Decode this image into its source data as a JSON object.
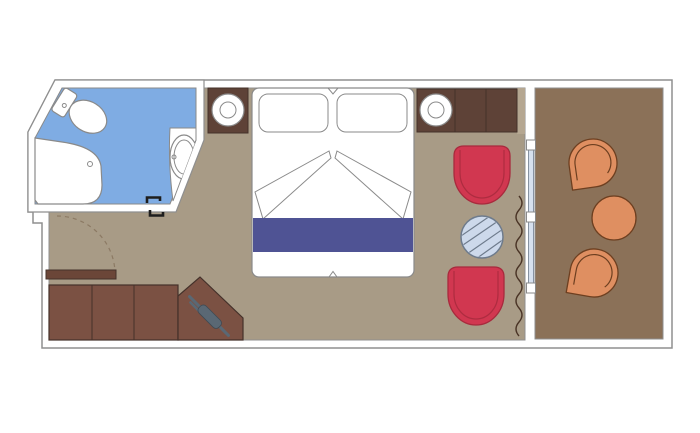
{
  "plan": {
    "type": "floor-plan",
    "rooms": {
      "bathroom": {
        "name": "bathroom",
        "fixtures": [
          "toilet",
          "shower",
          "washbasin-with-counter",
          "door-opening"
        ]
      },
      "cabin": {
        "name": "stateroom",
        "furniture": [
          "entrance-door",
          "wardrobe",
          "desk-with-hairdryer",
          "double-bed",
          "pillow-left",
          "pillow-right",
          "bed-runner",
          "nightstand-left",
          "nightstand-right",
          "lamp-left",
          "lamp-right",
          "cabinet",
          "armchair-upper",
          "round-glass-table",
          "armchair-lower",
          "curtain",
          "sliding-glass-door"
        ]
      },
      "balcony": {
        "name": "balcony",
        "furniture": [
          "deck-chair-upper",
          "round-table",
          "deck-chair-lower"
        ]
      }
    }
  },
  "colors": {
    "background": "#ffffff",
    "wall_fill": "#ffffff",
    "wall_stroke": "#8f8f8f",
    "fixture_fill": "#ffffff",
    "fixture_stroke": "#8a8a8a",
    "cabin_floor": "#A89B86",
    "cabin_floor_light": "#B5A791",
    "balcony_floor": "#8B7158",
    "bathroom_floor": "#7FACE3",
    "dark_wood": "#5E4237",
    "wardrobe_wood": "#7B5143",
    "door_wood": "#6B4638",
    "wood_stroke": "#44312A",
    "chair_red": "#D13750",
    "chair_red_stroke": "#A82A3D",
    "bed_runner": "#4F5394",
    "glass_table_fill": "#CDD9EB",
    "glass_table_stroke": "#6E7B8C",
    "glass_door_fill": "#D6E0EE",
    "balcony_furniture": "#DF8F61",
    "balcony_furniture_stroke": "#6D3F20",
    "curtain_stroke": "#4A3426",
    "swing_stroke": "#8C7A64",
    "appliance_gray": "#5A6874",
    "appliance_gray_dark": "#3F4A54",
    "door_mark_black": "#1E1E1E"
  }
}
